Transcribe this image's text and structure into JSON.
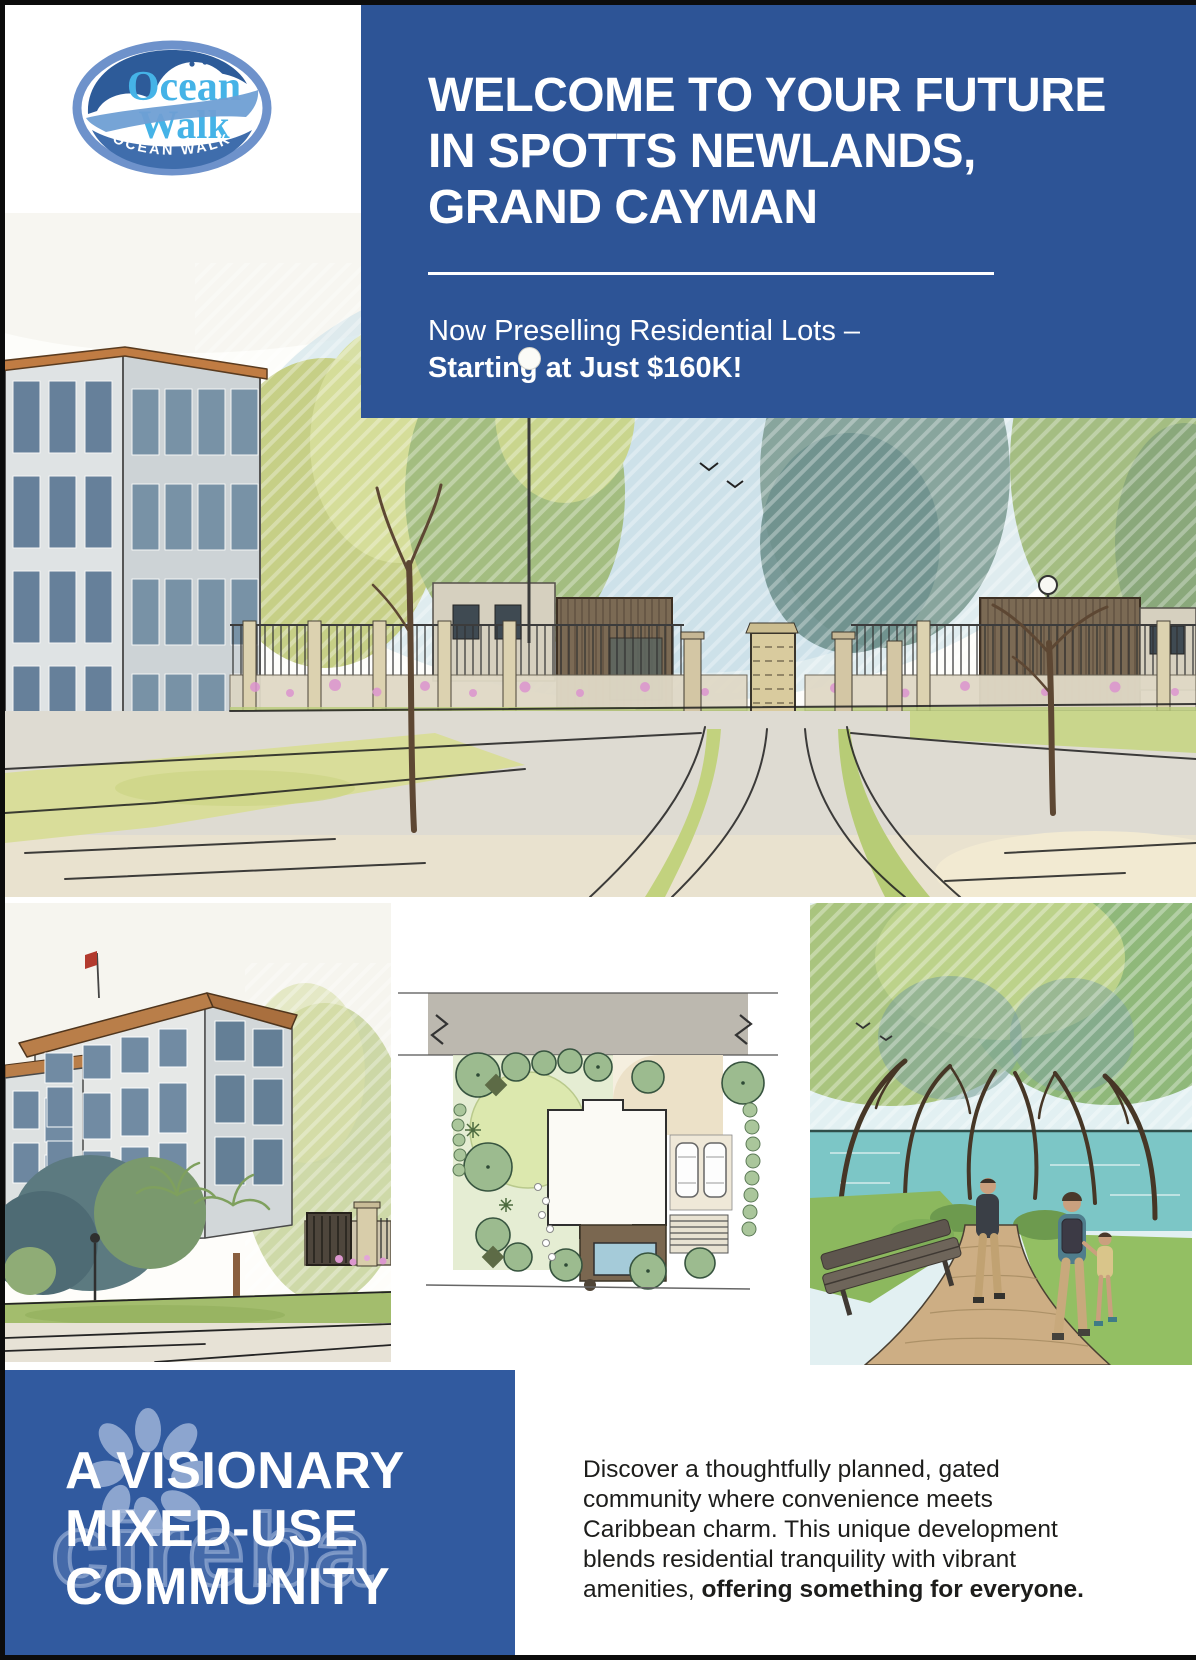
{
  "colors": {
    "banner_blue": "#2d5496",
    "box_blue": "#315a9f",
    "logo_light_blue": "#45b3e7",
    "logo_dark_blue": "#2d5b99",
    "logo_ring_blue": "#6e92cb",
    "watermark_blue": "#b0c3e2",
    "text_dark": "#1d1d1b"
  },
  "logo": {
    "word1": "Ocean",
    "word2": "Walk",
    "ribbon": "OCEAN WALK"
  },
  "banner": {
    "heading_lines": [
      "WELCOME TO YOUR FUTURE",
      "IN SPOTTS NEWLANDS,",
      "GRAND CAYMAN"
    ],
    "subtitle_regular": "Now Preselling Residential Lots –",
    "subtitle_bold": "Starting at Just $160K!"
  },
  "hero": {
    "alt": "Watercolor rendering of the gated community entrance with perimeter fence, stone gate pillars, gatehouses, trees and a four-storey residence"
  },
  "gallery": {
    "building": {
      "alt": "Watercolor rendering of a four-storey residential building with flag, palms, lawn and entrance gate"
    },
    "site_plan": {
      "alt": "Watercolor landscape site plan of a residential lot with house footprint, deck, pool, driveway, cars and gardens"
    },
    "walkway": {
      "alt": "Watercolor rendering of residents strolling a tree-lined lakeside walking path with a bench"
    }
  },
  "community": {
    "heading_lines": [
      "A VISIONARY",
      "MIXED-USE",
      "COMMUNITY"
    ],
    "watermark": "cireba"
  },
  "description": {
    "lines": [
      {
        "text": "Discover a thoughtfully planned, gated"
      },
      {
        "text": "community where convenience meets"
      },
      {
        "text": "Caribbean charm. This unique development"
      },
      {
        "text": "blends residential tranquility with vibrant"
      },
      {
        "text": "amenities, ",
        "bold": "offering something for everyone."
      }
    ]
  }
}
